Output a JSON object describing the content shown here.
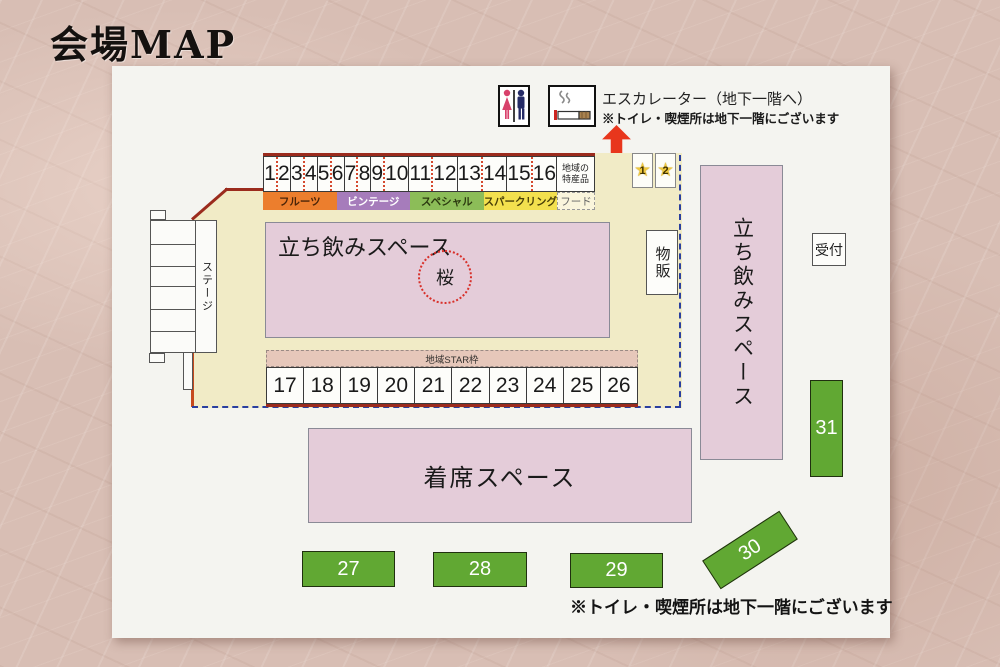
{
  "page": {
    "title": "会場MAP"
  },
  "legend": {
    "escalator_label": "エスカレーター（地下一階へ）",
    "escalator_note": "※トイレ・喫煙所は地下一階にございます"
  },
  "top_booths": {
    "numbers": [
      "1",
      "2",
      "3",
      "4",
      "5",
      "6",
      "7",
      "8",
      "9",
      "10",
      "11",
      "12",
      "13",
      "14",
      "15",
      "16"
    ],
    "special_box": {
      "line1": "地域の",
      "line2": "特産品"
    },
    "categories": [
      {
        "label": "フルーツ",
        "color": "#ec7e2d"
      },
      {
        "label": "ビンテージ",
        "color": "#a67cbb"
      },
      {
        "label": "スペシャル",
        "color": "#8cbd58"
      },
      {
        "label": "スパークリング",
        "color": "#f3e04e"
      },
      {
        "label": "フード",
        "color": "#faf5dc"
      }
    ]
  },
  "star_booths": [
    {
      "number": "1"
    },
    {
      "number": "2"
    }
  ],
  "areas": {
    "stage": "ステージ",
    "standing_space_main": "立ち飲みスペース",
    "sakura_circle": "桜",
    "goods_sales": "物販",
    "standing_space_right": "立ち飲みスペース",
    "reception": "受付",
    "seating_space": "着席スペース",
    "regional_star_frame": "地域STAR枠"
  },
  "bottom_booths": [
    "17",
    "18",
    "19",
    "20",
    "21",
    "22",
    "23",
    "24",
    "25",
    "26"
  ],
  "green_booths": [
    "27",
    "28",
    "29",
    "30",
    "31"
  ],
  "footer": {
    "note": "※トイレ・喫煙所は地下一階にございます"
  },
  "colors": {
    "area_pink": "#e4ccd9",
    "map_floor_beige": "#f1ebc6",
    "green_booth": "#61a833",
    "accent_dark_red_line": "#9b2b1d",
    "accent_orange_line": "#c64a1e",
    "blue_dashed_line": "#2a3f9f",
    "arrow_red": "#e8361c",
    "star_yellow": "#efc83d",
    "star_frame_strip": "#e6c7ba",
    "category_fruit": "#ec7e2d",
    "category_vintage": "#a67cbb",
    "category_special": "#8cbd58",
    "category_sparkling": "#f3e04e"
  }
}
